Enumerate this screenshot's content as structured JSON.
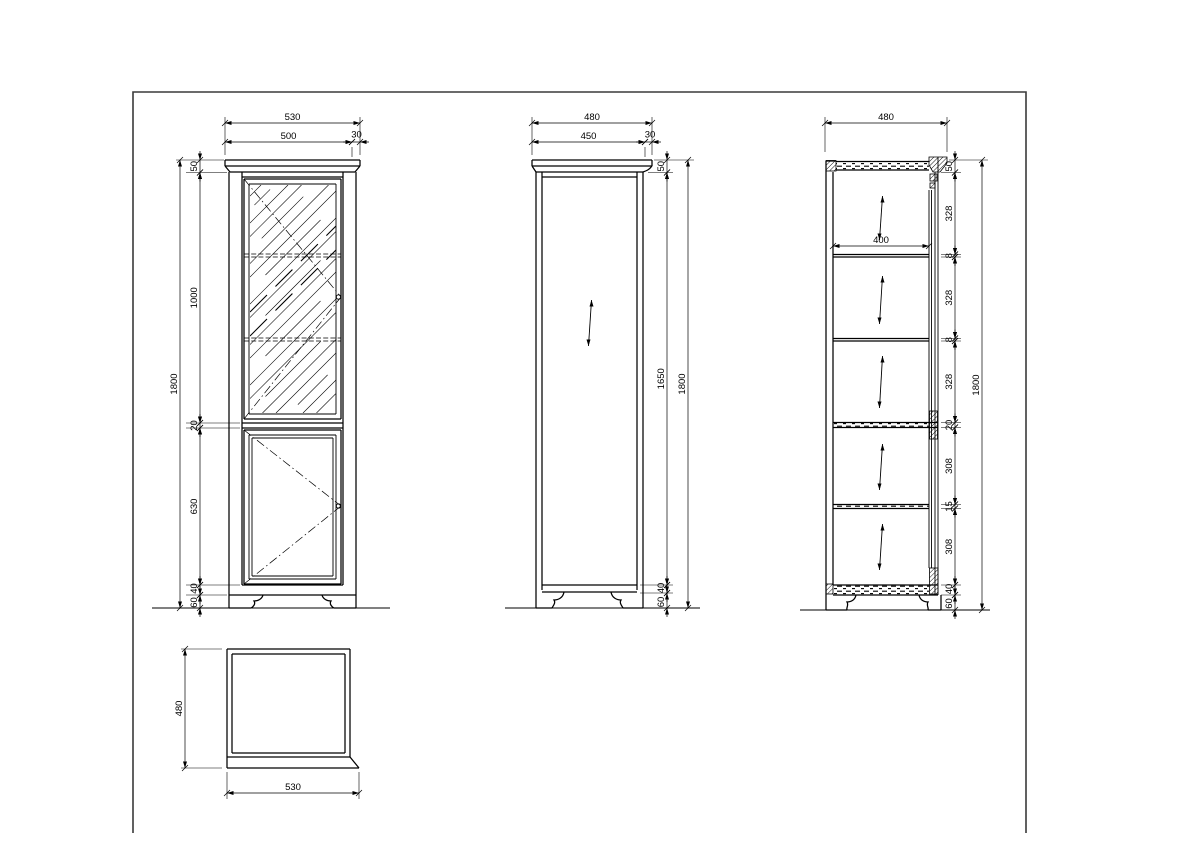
{
  "front_view": {
    "width_total": "530",
    "width_body": "500",
    "crown_overhang": "30",
    "crown_height": "50",
    "glass_door_height": "1000",
    "mid_rail": "20",
    "lower_door_height": "630",
    "bottom_rail": "40",
    "foot_height": "60",
    "height_total": "1800"
  },
  "side_view": {
    "depth_total": "480",
    "depth_body": "450",
    "crown_overhang": "30",
    "crown_height": "50",
    "inner_height": "1650",
    "bottom_rail": "40",
    "foot_height": "60",
    "height_total": "1800"
  },
  "section_view": {
    "depth_total": "480",
    "shelf_width": "400",
    "crown_height": "50",
    "bay_1": "328",
    "shelf_1": "8",
    "bay_2": "328",
    "shelf_2": "8",
    "bay_3": "328",
    "mid_rail": "20",
    "bay_4": "308",
    "shelf_3": "15",
    "bay_5": "308",
    "bottom_rail": "40",
    "foot_height": "60",
    "height_total": "1800"
  },
  "top_view": {
    "depth": "480",
    "width": "530"
  }
}
